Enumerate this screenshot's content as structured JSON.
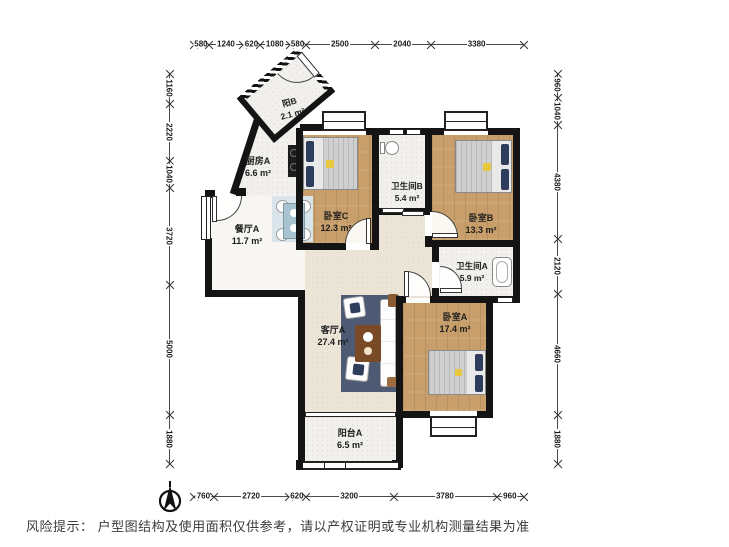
{
  "colors": {
    "wall": "#141414",
    "wood": "#c89e6a",
    "tile": "#f2f0ec",
    "beige": "#ebe4d7",
    "dining": "#f7f6f3",
    "pillow": "#2e3d5c",
    "accent": "#e9c83f",
    "rug": "#4e5a74"
  },
  "rooms": [
    {
      "id": "balcony-b",
      "label": "阳B",
      "area": "2.1 m²"
    },
    {
      "id": "kitchen-a",
      "label": "厨房A",
      "area": "6.6 m²"
    },
    {
      "id": "bedroom-c",
      "label": "卧室C",
      "area": "12.3 m²"
    },
    {
      "id": "bathroom-b",
      "label": "卫生间B",
      "area": "5.4 m²"
    },
    {
      "id": "bedroom-b",
      "label": "卧室B",
      "area": "13.3 m²"
    },
    {
      "id": "dining-a",
      "label": "餐厅A",
      "area": "11.7 m²"
    },
    {
      "id": "bathroom-a",
      "label": "卫生间A",
      "area": "5.9 m²"
    },
    {
      "id": "living-a",
      "label": "客厅A",
      "area": "27.4 m²"
    },
    {
      "id": "bedroom-a",
      "label": "卧室A",
      "area": "17.4 m²"
    },
    {
      "id": "balcony-a",
      "label": "阳台A",
      "area": "6.5 m²"
    }
  ],
  "dimensions": {
    "unit": "mm",
    "top": [
      580,
      1240,
      620,
      1080,
      580,
      2500,
      2040,
      3380
    ],
    "bottom": [
      760,
      2720,
      620,
      3200,
      3780,
      960
    ],
    "left": [
      1160,
      2220,
      1040,
      3720,
      5000,
      1880
    ],
    "right": [
      960,
      1040,
      4380,
      2120,
      4660,
      1880
    ]
  },
  "footer": {
    "risk_notice": "风险提示： 户型图结构及使用面积仅供参考，请以产权证明或专业机构测量结果为准"
  }
}
